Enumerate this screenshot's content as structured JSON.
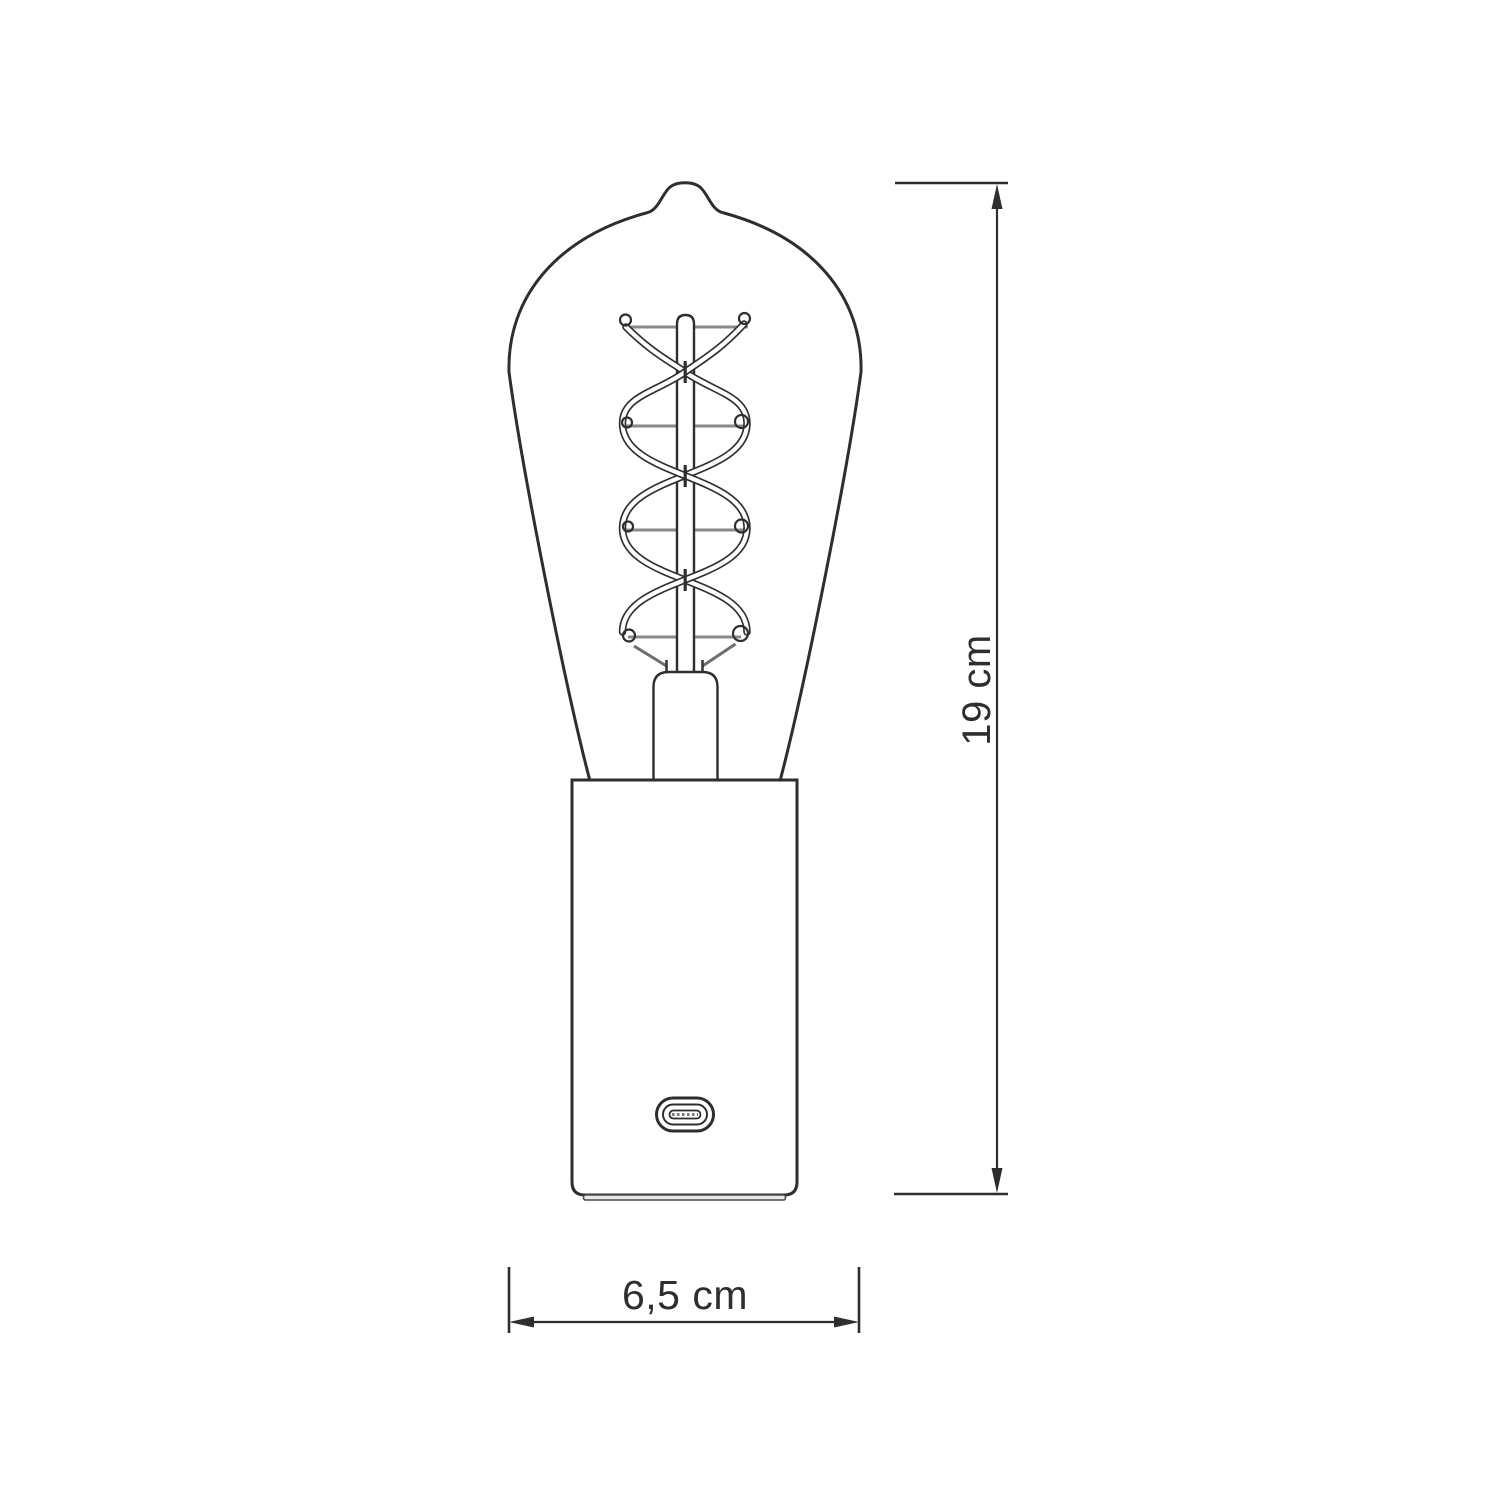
{
  "page": {
    "background_color": "#ffffff"
  },
  "diagram": {
    "subject": "technical dimension drawing of a table lamp: ST64 Edison bulb with double-spiral filament on a cylindrical socket base with USB-C port",
    "style": {
      "outline_color": "#2e2e2e",
      "support_wire_color": "#8a8a8a",
      "lead_wire_color": "#6e6e6e",
      "fill_color": "#ffffff"
    },
    "dimensions": {
      "height": {
        "label": "19 cm",
        "orientation": "vertical"
      },
      "width": {
        "label": "6,5 cm",
        "orientation": "horizontal"
      }
    }
  }
}
